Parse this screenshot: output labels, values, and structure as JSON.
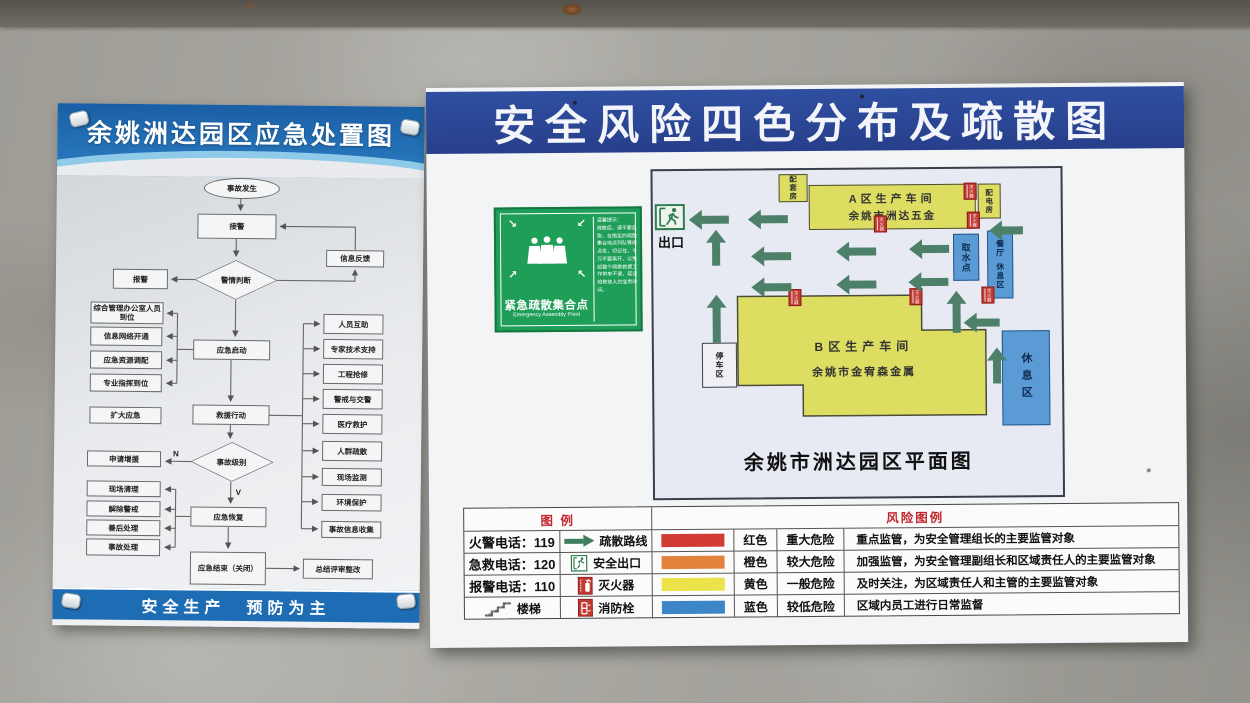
{
  "colors": {
    "right_title_blue": "#2c4a99",
    "left_header_blue": "#2272b8",
    "building_yellow": "#dddd62",
    "area_blue": "#5b9bd5",
    "arrow_green": "#4d8069",
    "sign_green": "#1f9e58",
    "risk_red": "#d23b33",
    "risk_orange": "#e2823c",
    "risk_yellow": "#ece34a",
    "risk_blue": "#3c85c6"
  },
  "left_poster": {
    "title": "余姚洲达园区应急处置图",
    "footer": "安全生产　预防为主",
    "flow": {
      "start": "事故发生",
      "jiejing": "接警",
      "xinxifankui": "信息反馈",
      "jingqing": "警情判断",
      "baojing": "报警",
      "zonghe": "综合管理办公室人员到位",
      "wangluo": "信息网络开通",
      "ziyuan": "应急资源调配",
      "zhihui": "专业指挥到位",
      "qidong": "应急启动",
      "kuoda": "扩大应急",
      "jiuyuan": "救援行动",
      "right": [
        "人员互助",
        "专家技术支持",
        "工程抢修",
        "警戒与交警",
        "医疗救护",
        "人群疏散",
        "现场监测",
        "环境保护",
        "事故信息收集"
      ],
      "shenqing": "申请增援",
      "jibie": "事故级别",
      "n": "N",
      "v": "V",
      "qingli": "现场清理",
      "jiechu": "解除警戒",
      "shanhou": "善后处理",
      "shigu": "事故处理",
      "huifu": "应急恢复",
      "jieshu": "应急结束（关闭）",
      "zongjie": "总结评审整改"
    }
  },
  "right_poster": {
    "title": "安全风险四色分布及疏散图",
    "assembly": {
      "title": "紧急疏散集合点",
      "subtitle": "Emergency Assembly Point",
      "tips_heading": "温馨提示：",
      "tips_body": "疏散后，请不要乱跑，在指定的疏散集合地点列队等候点名，切记住，千万不要离开，以免给整个疏散救援工作带来不便，延误抢救他人的宝贵时间。"
    },
    "map": {
      "exit": "出口",
      "caption": "余姚市洲达园区平面图",
      "peitaofang": "配套房",
      "a1": "A区生产车间",
      "a2": "余姚市洲达五金",
      "peidianfang": "配电房",
      "qushui": "取水点",
      "canting": "餐厅",
      "canting2": "休息区",
      "xiuxi": "休息区",
      "b1": "B区生产车间",
      "b2": "余姚市金宥森金属",
      "tingche": "停车区",
      "marker": "灭火器"
    },
    "legend": {
      "header_left": "图 例",
      "header_right": "风险图例",
      "rows": [
        {
          "c1": "火警电话：119",
          "symbol": "疏散路线",
          "name": "红色",
          "level": "重大危险",
          "desc": "重点监管，为安全管理组长的主要监管对象",
          "bar": "background:#d23b33"
        },
        {
          "c1": "急救电话：120",
          "symbol": "安全出口",
          "name": "橙色",
          "level": "较大危险",
          "desc": "加强监管，为安全管理副组长和区域责任人的主要监管对象",
          "bar": "background:#e2823c"
        },
        {
          "c1": "报警电话：110",
          "symbol": "灭火器",
          "name": "黄色",
          "level": "一般危险",
          "desc": "及时关注，为区域责任人和主管的主要监管对象",
          "bar": "background:#ece34a"
        },
        {
          "c1": "楼梯",
          "symbol": "消防栓",
          "name": "蓝色",
          "level": "较低危险",
          "desc": "区域内员工进行日常监督",
          "bar": "background:#3c85c6"
        }
      ]
    }
  }
}
